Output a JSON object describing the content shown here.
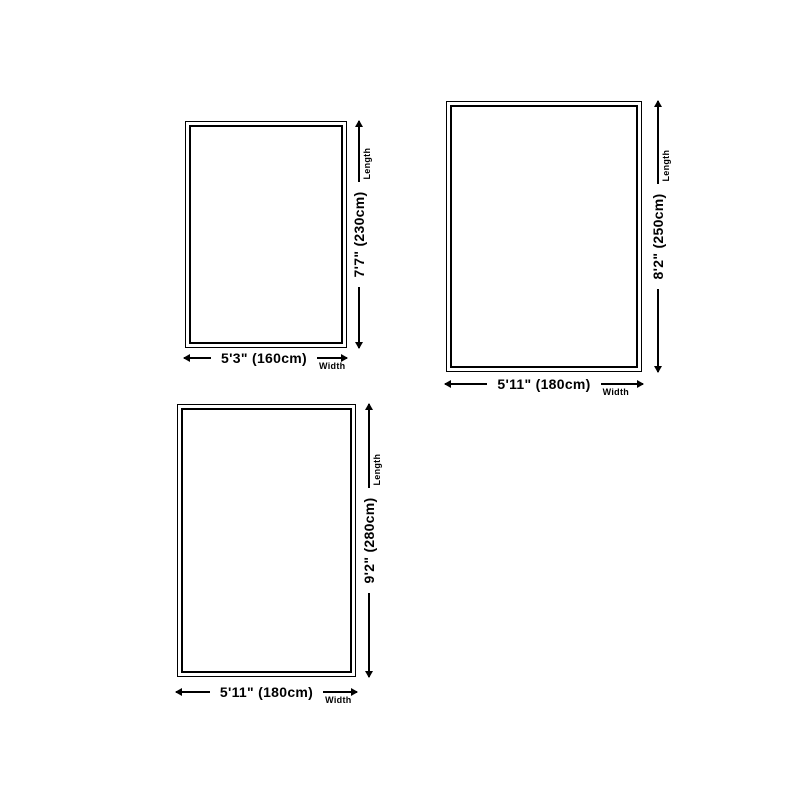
{
  "diagram": {
    "background": "#ffffff",
    "line_color": "#000000",
    "rugs": [
      {
        "name": "rug-160x230",
        "width_label": "5'3\" (160cm)",
        "width_axis": "Width",
        "length_label": "7'7\" (230cm)",
        "length_axis": "Length"
      },
      {
        "name": "rug-180x250",
        "width_label": "5'11\" (180cm)",
        "width_axis": "Width",
        "length_label": "8'2\" (250cm)",
        "length_axis": "Length"
      },
      {
        "name": "rug-180x280",
        "width_label": "5'11\" (180cm)",
        "width_axis": "Width",
        "length_label": "9'2\" (280cm)",
        "length_axis": "Length"
      }
    ]
  }
}
